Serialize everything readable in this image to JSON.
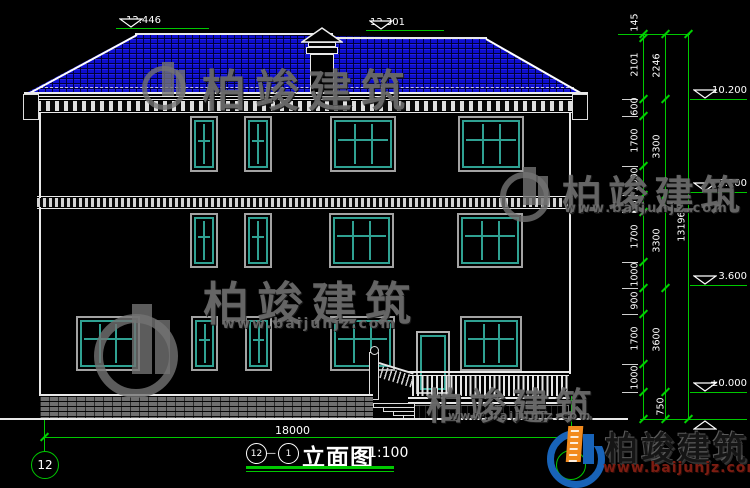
{
  "watermark": {
    "brand": "柏竣建筑",
    "url": "www.baijunjz.com"
  },
  "logo": {
    "brand": "柏竣建筑",
    "url": "www.baijunjz.com"
  },
  "title_block": {
    "grid_from": "12",
    "grid_to": "1",
    "separator": "—",
    "name": "立面图",
    "scale": "1:100"
  },
  "grid": {
    "left_bubble": "12"
  },
  "dims": {
    "total_width": "18000",
    "chain_inner": [
      "145",
      "2101",
      "600",
      "1700",
      "1000",
      "600",
      "1700",
      "1000",
      "900",
      "1700",
      "1000",
      "750"
    ],
    "chain_middle": [
      "2246",
      "3300",
      "3300",
      "3600"
    ],
    "chain_total": "13196"
  },
  "elevations": {
    "top_left": "12.446",
    "top_right": "12.301",
    "right": [
      "10.200",
      "6.900",
      "3.600",
      "±0.000"
    ]
  }
}
